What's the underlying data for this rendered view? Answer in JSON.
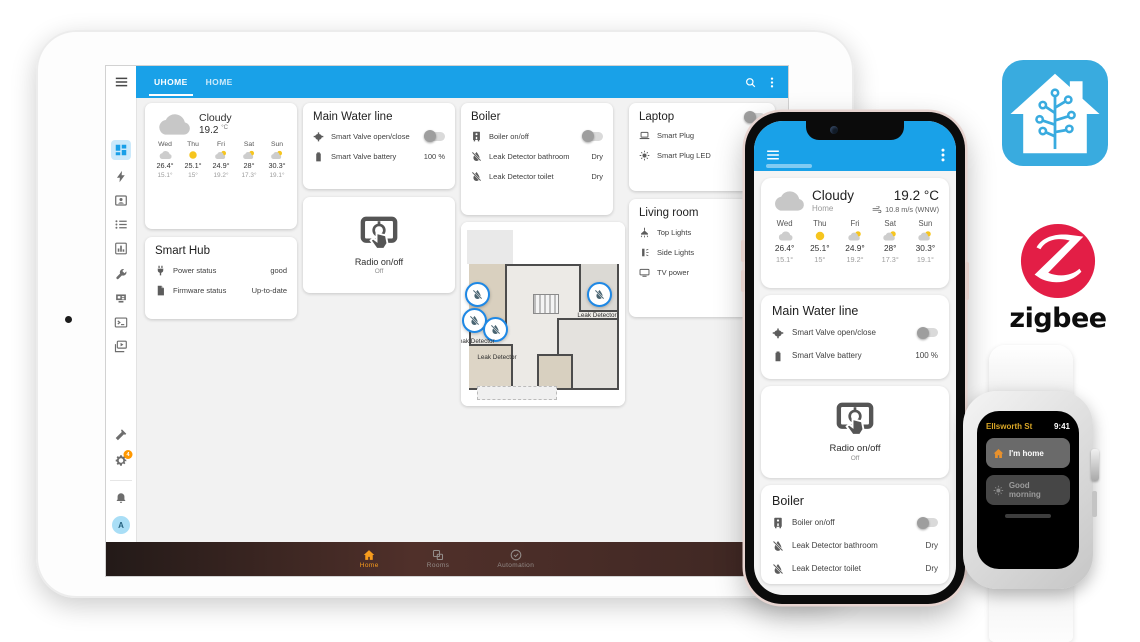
{
  "colors": {
    "primary_blue": "#19a1e8",
    "ha_logo_blue": "#39abdf",
    "zigbee_red": "#e31e46",
    "nav_orange": "#f79c1d",
    "badge_orange": "#ff9800"
  },
  "weather": {
    "condition": "Cloudy",
    "location": "Home",
    "temp": "19.2",
    "unit": "°C",
    "wind": "10.8 m/s (WNW)",
    "forecast": [
      {
        "day": "Wed",
        "icon": "cloudy",
        "high": "26.4°",
        "low": "15.1°"
      },
      {
        "day": "Thu",
        "icon": "sunny",
        "high": "25.1°",
        "low": "15°"
      },
      {
        "day": "Fri",
        "icon": "partly",
        "high": "24.9°",
        "low": "19.2°"
      },
      {
        "day": "Sat",
        "icon": "partly",
        "high": "28°",
        "low": "17.3°"
      },
      {
        "day": "Sun",
        "icon": "partly",
        "high": "30.3°",
        "low": "19.1°"
      }
    ]
  },
  "dashboard": {
    "hub": {
      "title": "Smart Hub",
      "rows": [
        {
          "icon": "power-plug",
          "label": "Power status",
          "value": "good"
        },
        {
          "icon": "file",
          "label": "Firmware status",
          "value": "Up-to-date"
        }
      ]
    },
    "water": {
      "title": "Main Water line",
      "rows": [
        {
          "icon": "valve",
          "label": "Smart Valve open/close",
          "control": "toggle",
          "state": "off"
        },
        {
          "icon": "battery",
          "label": "Smart Valve battery",
          "value": "100 %"
        }
      ]
    },
    "radio": {
      "label": "Radio on/off",
      "state": "Off"
    },
    "boiler": {
      "title": "Boiler",
      "rows": [
        {
          "icon": "boiler",
          "label": "Boiler on/off",
          "control": "toggle",
          "state": "off"
        },
        {
          "icon": "leak",
          "label": "Leak Detector bathroom",
          "value": "Dry"
        },
        {
          "icon": "leak",
          "label": "Leak Detector toilet",
          "value": "Dry"
        }
      ]
    },
    "laptop": {
      "title": "Laptop",
      "toggle_state": "off",
      "rows": [
        {
          "icon": "laptop",
          "label": "Smart Plug"
        },
        {
          "icon": "led",
          "label": "Smart Plug LED"
        }
      ]
    },
    "living": {
      "title": "Living room",
      "rows": [
        {
          "icon": "ceiling-light",
          "label": "Top Lights"
        },
        {
          "icon": "wall-light",
          "label": "Side Lights"
        },
        {
          "icon": "tv",
          "label": "TV power"
        }
      ]
    },
    "floorplan": {
      "marker_label": "Leak Detector",
      "marker_count": 4
    }
  },
  "tablet": {
    "tabs": [
      {
        "label": "UHOME",
        "active": true
      },
      {
        "label": "HOME",
        "active": false
      }
    ],
    "sidebar": {
      "badge": "4",
      "avatar": "A",
      "items": [
        "menu",
        "dashboard",
        "energy",
        "devices",
        "logbook",
        "history",
        "tools",
        "hacs",
        "terminal",
        "media",
        "developer-tools",
        "settings",
        "notifications",
        "user"
      ]
    },
    "bottom_nav": [
      {
        "label": "Home",
        "active": true
      },
      {
        "label": "Rooms",
        "active": false
      },
      {
        "label": "Automation",
        "active": false
      }
    ]
  },
  "watch": {
    "title": "Ellsworth St",
    "time": "9:41",
    "buttons": [
      {
        "label": "I'm home"
      },
      {
        "label": "Good morning"
      }
    ]
  },
  "logos": {
    "zigbee": "zigbee"
  }
}
